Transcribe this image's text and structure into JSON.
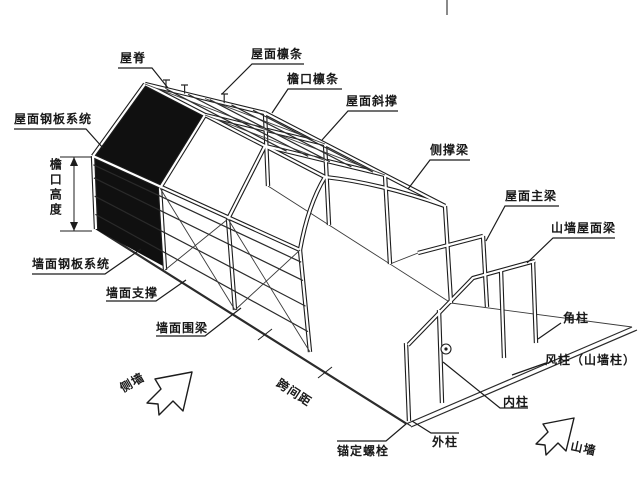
{
  "labels": {
    "ridge": "屋脊",
    "roof_purlin": "屋面檩条",
    "eave_purlin": "檐口檩条",
    "roof_brace": "屋面斜撑",
    "eave_strut": "侧撑梁",
    "roof_main_beam": "屋面主梁",
    "gable_roof_beam": "山墙屋面梁",
    "corner_column": "角柱",
    "wind_column": "风柱（山墙柱）",
    "inner_column": "内柱",
    "outer_column": "外柱",
    "anchor_bolt": "锚定螺栓",
    "roof_panel_system": "屋面钢板系统",
    "wall_panel_system": "墙面钢板系统",
    "wall_brace": "墙面支撑",
    "wall_girt": "墙面围梁",
    "bay_spacing": "跨间距",
    "side_wall": "侧墙",
    "gable_wall": "山墙",
    "eave_height": "檐口高度"
  }
}
